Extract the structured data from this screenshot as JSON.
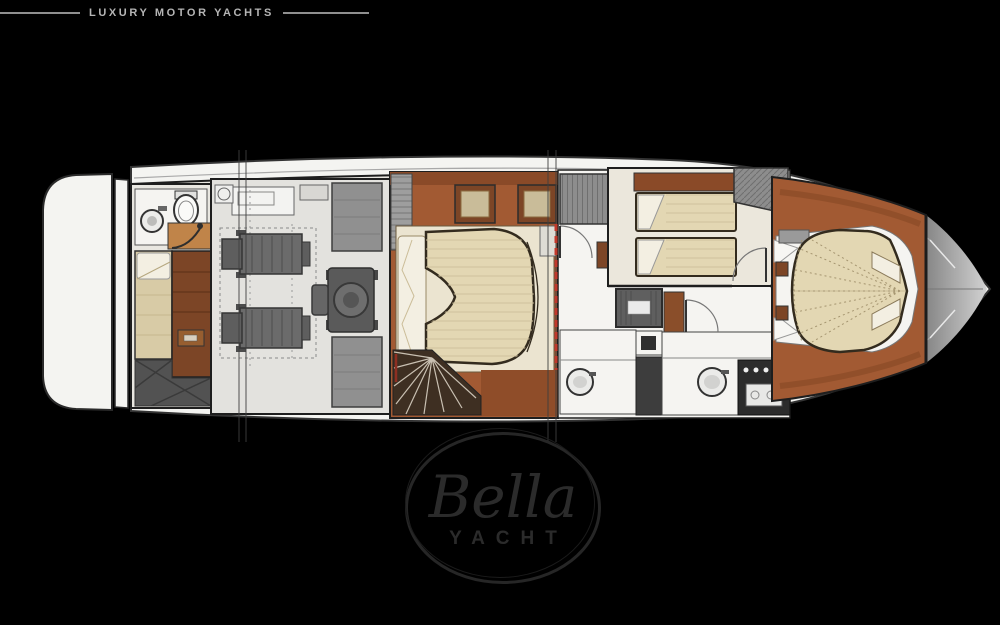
{
  "header": {
    "brand": "LUXURY MOTOR YACHTS"
  },
  "watermark": {
    "name": "Bella",
    "subtitle": "YACHT"
  },
  "colors": {
    "background": "#000000",
    "header_text": "#b5b5b5",
    "header_line": "#8f8f8f",
    "hull_white": "#f4f4f1",
    "outline_dark": "#1e1e1e",
    "floor_light": "#e9e7e1",
    "floor_white": "#f5f4f1",
    "terracotta": "#a25a33",
    "terracotta_dark": "#8a4a28",
    "wood_brown": "#7c4526",
    "bed_beige": "#e3d7b3",
    "bed_stripe": "#cfc19c",
    "pillow_cream": "#f3efe2",
    "carpet_cream": "#ebe4d0",
    "berth_tan": "#d8cba6",
    "machinery_gray": "#6b6b6b",
    "closet_gray": "#8d8d8d",
    "deck_gray": "#9b9b9b",
    "dark_floor": "#525252",
    "stair_brown": "#3e2f22",
    "bulkhead_red": "#c1392b",
    "watermark_line": "#262626",
    "watermark_text": "#2b2b2b"
  }
}
